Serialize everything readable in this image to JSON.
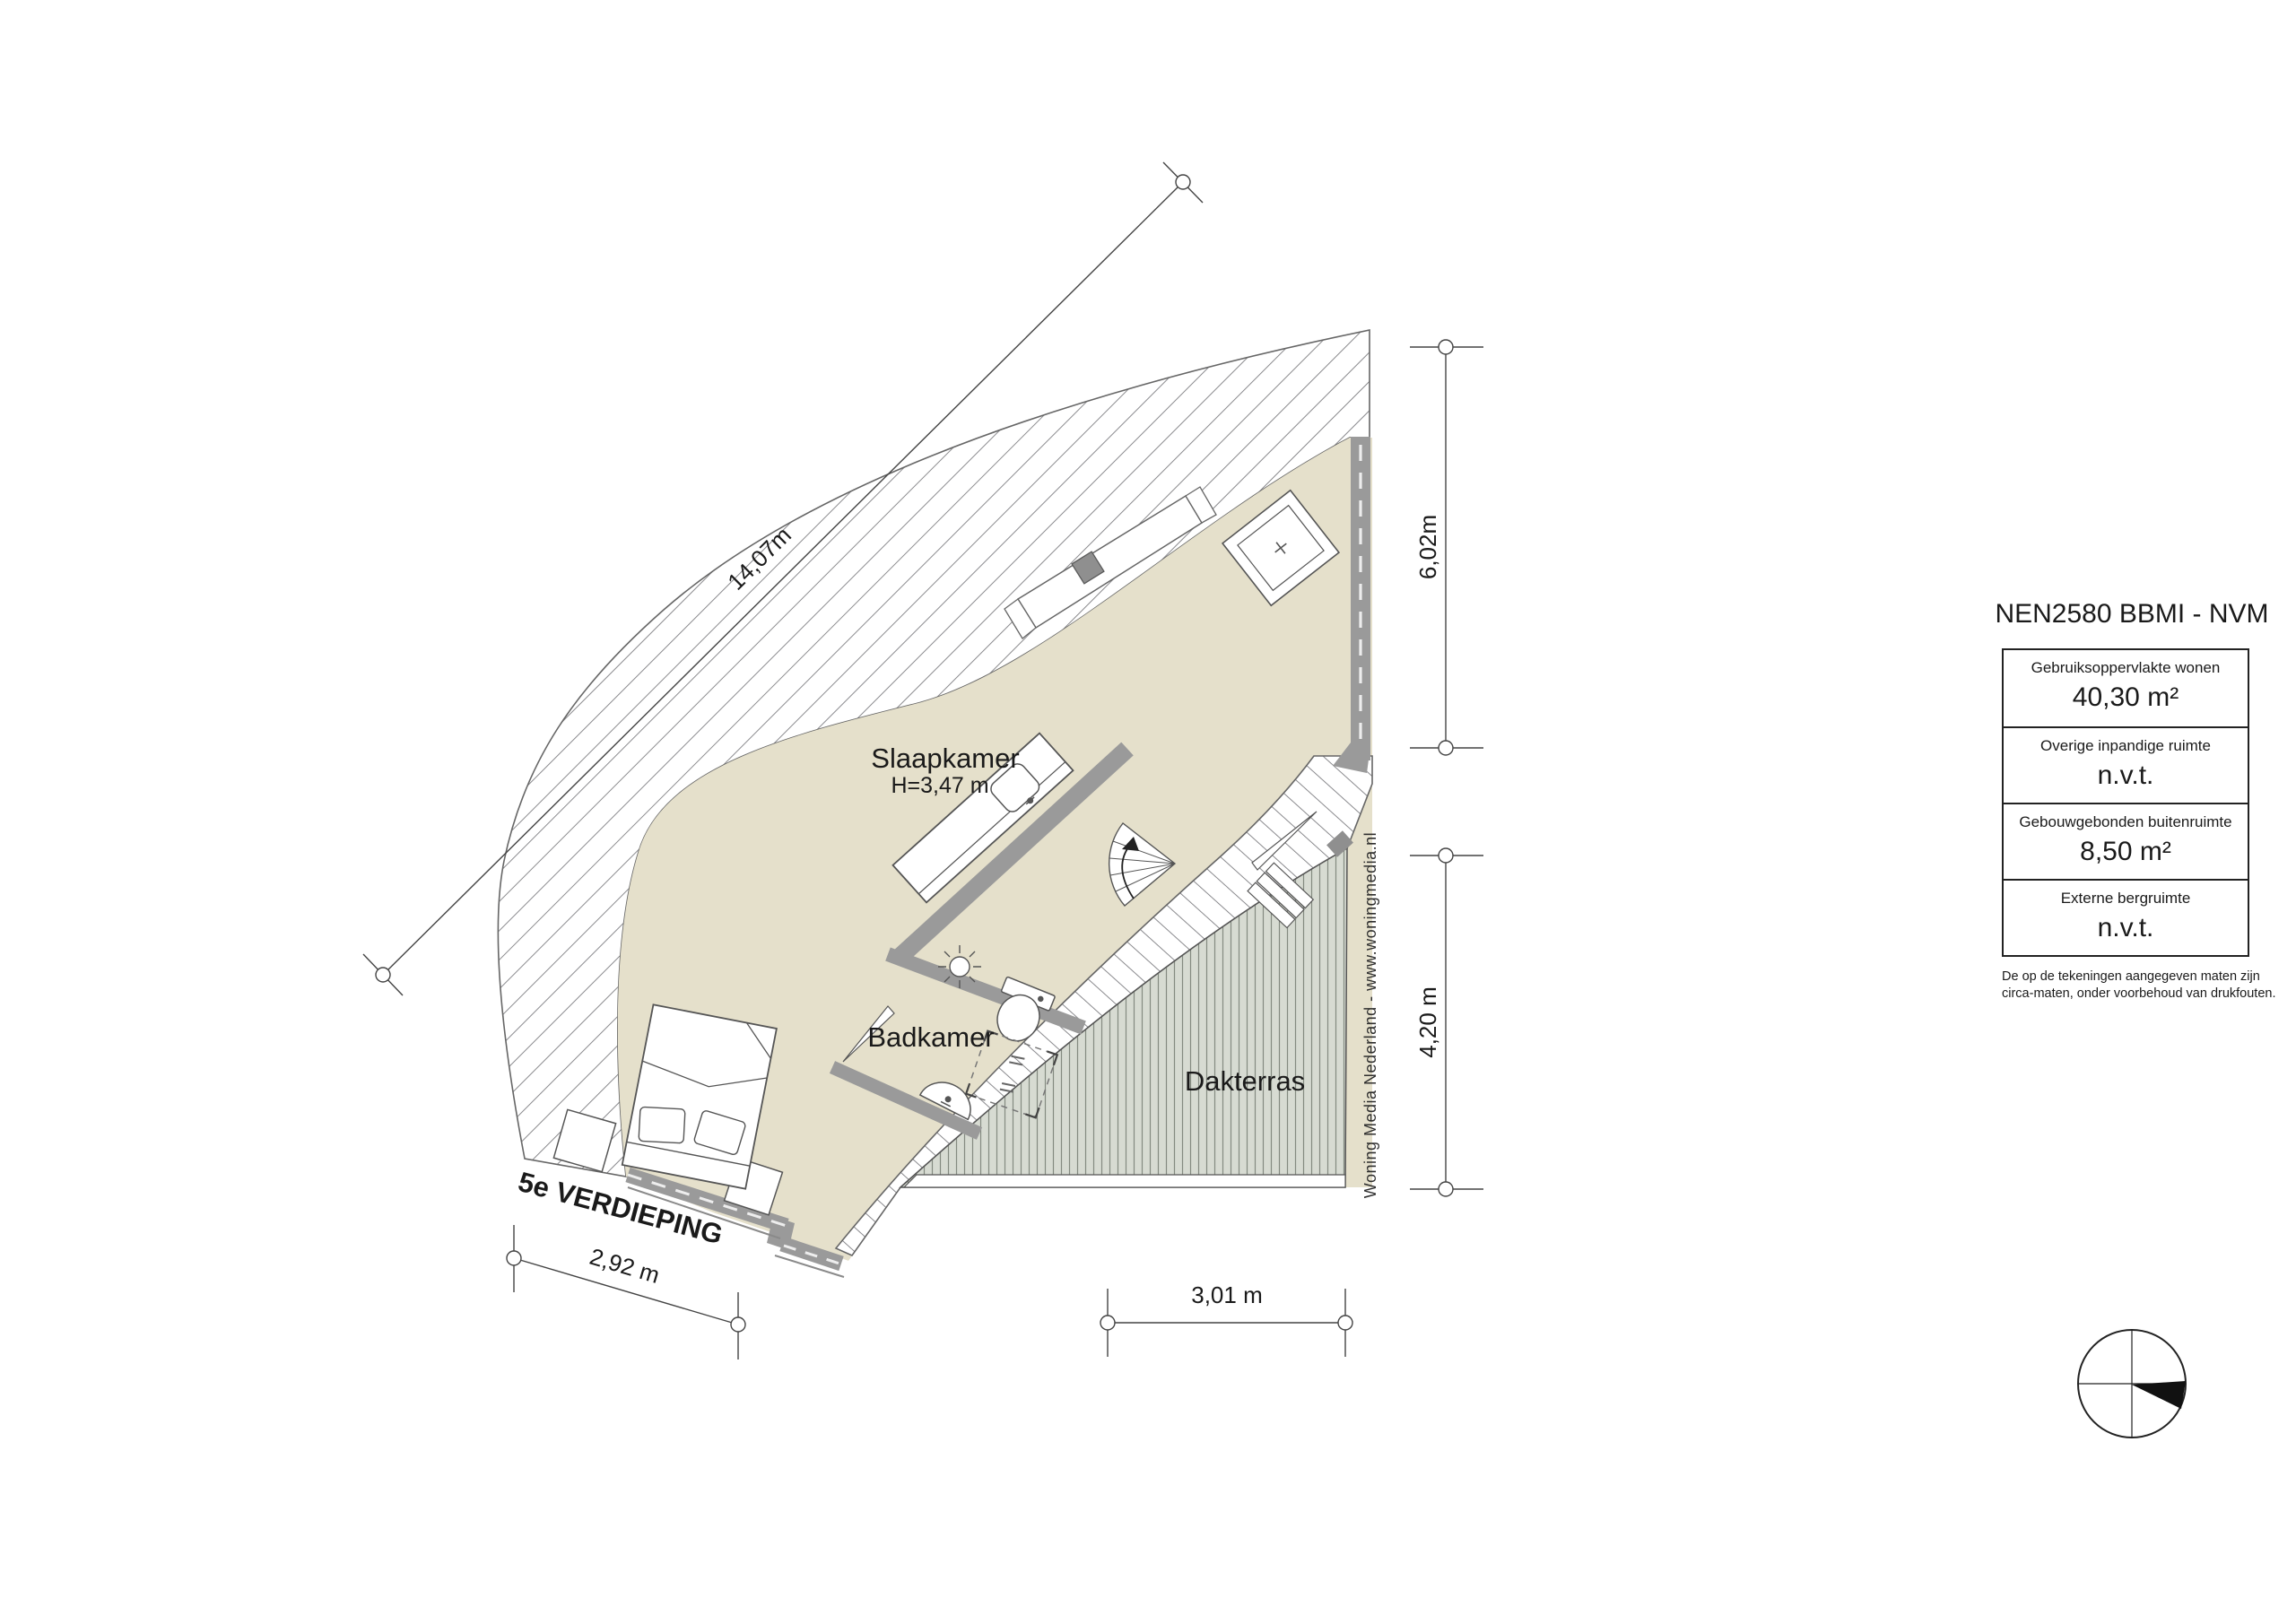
{
  "floorplan": {
    "floor_label": "5e VERDIEPING",
    "rooms": {
      "bedroom": {
        "name": "Slaapkamer",
        "height_note": "H=3,47 m"
      },
      "bathroom": {
        "name": "Badkamer"
      },
      "terrace": {
        "name": "Dakterras"
      }
    },
    "dimensions": {
      "diagonal": "14,07m",
      "right_upper": "6,02m",
      "right_lower": "4,20 m",
      "bottom_left": "2,92 m",
      "bottom_center": "3,01 m"
    }
  },
  "legend_table": {
    "title": "NEN2580 BBMI - NVM",
    "rows": [
      {
        "label": "Gebruiksoppervlakte wonen",
        "value": "40,30 m²"
      },
      {
        "label": "Overige inpandige ruimte",
        "value": "n.v.t."
      },
      {
        "label": "Gebouwgebonden buitenruimte",
        "value": "8,50 m²"
      },
      {
        "label": "Externe bergruimte",
        "value": "n.v.t."
      }
    ],
    "footnote_line1": "De op de tekeningen aangegeven maten zijn",
    "footnote_line2": "circa-maten, onder voorbehoud van drukfouten."
  },
  "credit": "Woning Media Nederland - www.woningmedia.nl",
  "colors": {
    "floor": "#e5e0cb",
    "wall": "#9a9a9a",
    "terrace_deck": "#d7dbd2",
    "hatch_line": "#76767a",
    "outline": "#555555"
  }
}
